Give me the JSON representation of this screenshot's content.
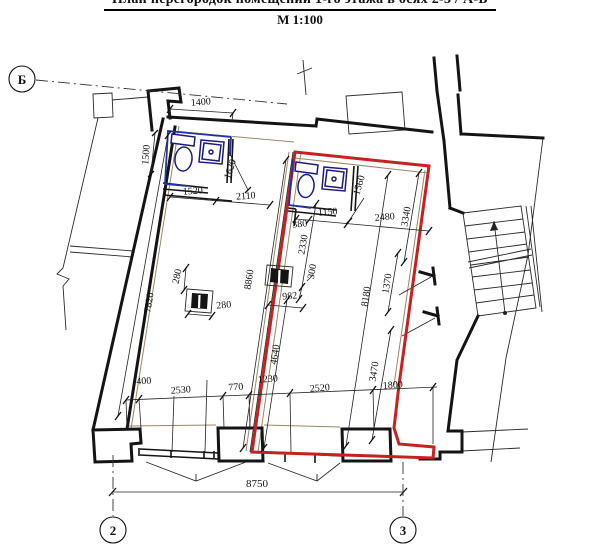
{
  "header": {
    "title": "План перегородок помещений 1-го этажа в осях 2-3 / А-Б",
    "scale": "М 1:100"
  },
  "axis_markers": {
    "row_letter": "Б",
    "col_left": "2",
    "col_right": "3"
  },
  "dimensions_mm": {
    "top_width": "1400",
    "left_height": "1500",
    "bath1_width": "1520",
    "room1_top": "2110",
    "bath1_diag": "1620",
    "bath2_width": "1150",
    "bath2_step": "380",
    "room2_top": "2480",
    "bath2_diag": "1560",
    "room2_right_upper": "3340",
    "partition_upper": "2330",
    "partition_step": "300",
    "partition_offset": "982",
    "room1_length": "8860",
    "room1_left_length": "7820",
    "room2_length": "8180",
    "room2_right_mid": "1370",
    "room2_right_lower": "3470",
    "partition_lower": "4640",
    "column_width": "280",
    "column_depth": "280",
    "bottom_wall": "400",
    "bottom_window1": "2530",
    "bottom_pier1": "770",
    "bottom_pier2": "1230",
    "bottom_window2": "2520",
    "bottom_right": "1800",
    "axis_span": "8750"
  },
  "colors": {
    "wall": "#141414",
    "room2_outline": "#c82020",
    "plumbing_fixture": "#1b1b7a",
    "bath_finish": "#2233aa",
    "partition_finish": "#9b8666"
  }
}
